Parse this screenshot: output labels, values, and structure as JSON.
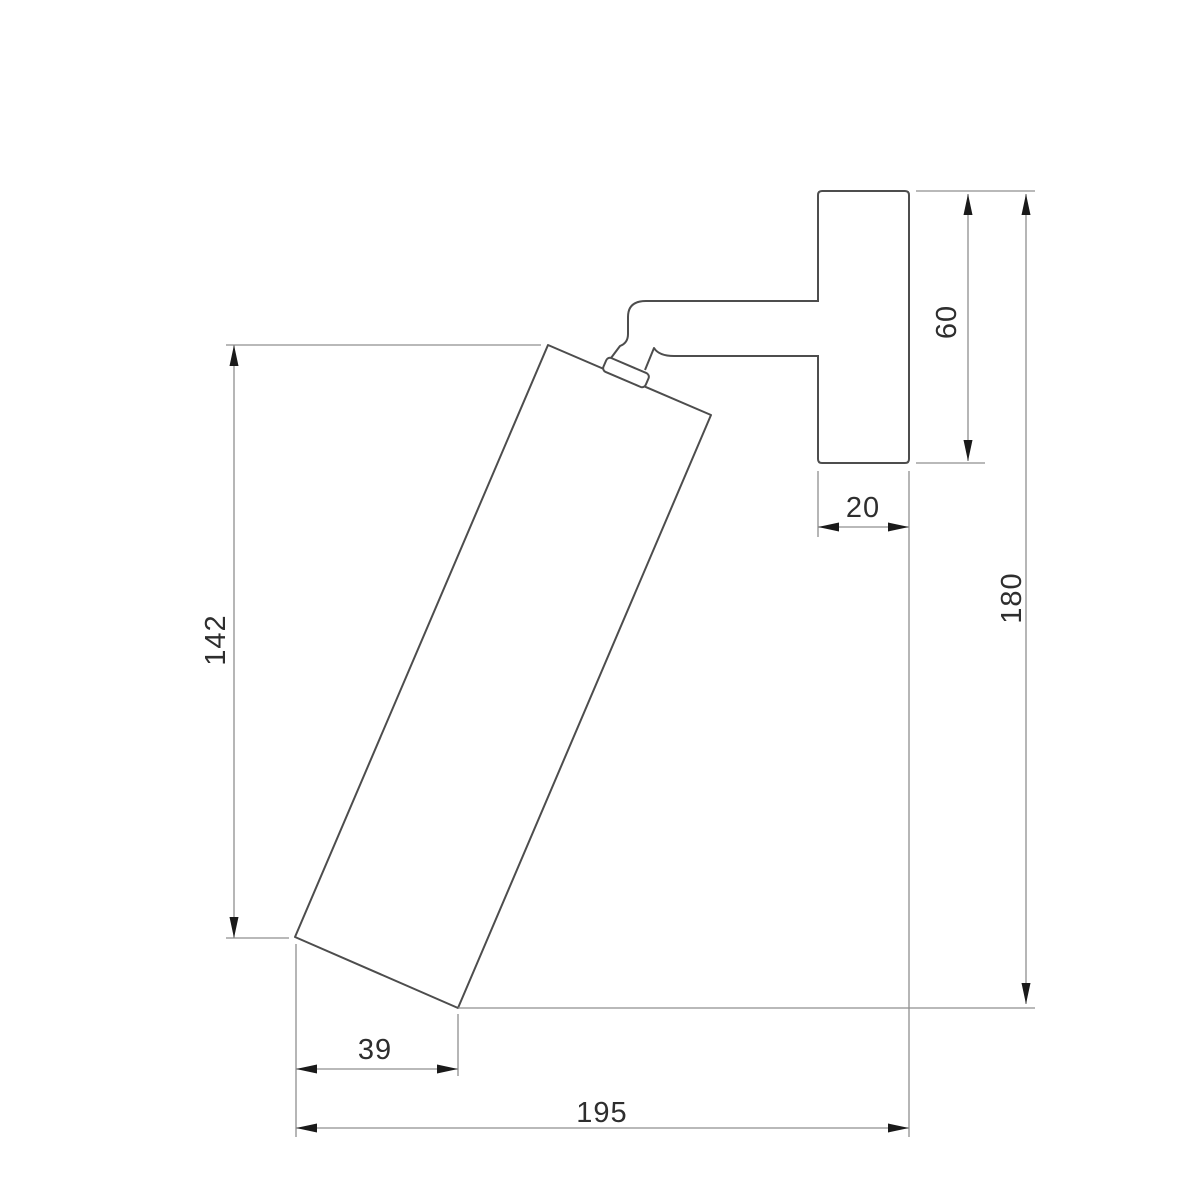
{
  "drawing": {
    "kind": "technical dimension drawing",
    "subject": "wall-mounted adjustable spot light, side elevation",
    "units_implied": "mm",
    "parts": [
      "wall mounting plate",
      "horizontal support arm",
      "pivot collar joint",
      "tilted cylindrical lamp body"
    ]
  },
  "colors": {
    "background": "#ffffff",
    "object_line": "#4d4d4d",
    "dimension_line": "#8f8f8f",
    "arrow": "#1a1a1a",
    "text": "#2e2e2e"
  },
  "dimensions": {
    "body_length": {
      "value": "142",
      "orientation": "vertical",
      "location": "left side, lamp body vertical extent"
    },
    "plate_height": {
      "value": "60",
      "orientation": "vertical",
      "location": "right of mounting plate"
    },
    "plate_depth": {
      "value": "20",
      "orientation": "horizontal",
      "location": "below mounting plate"
    },
    "overall_height": {
      "value": "180",
      "orientation": "vertical",
      "location": "far right, overall extent"
    },
    "body_bottom_width": {
      "value": "39",
      "orientation": "horizontal",
      "location": "bottom left, lamp base projection"
    },
    "overall_depth": {
      "value": "195",
      "orientation": "horizontal",
      "location": "bottom, overall projection from wall"
    }
  }
}
